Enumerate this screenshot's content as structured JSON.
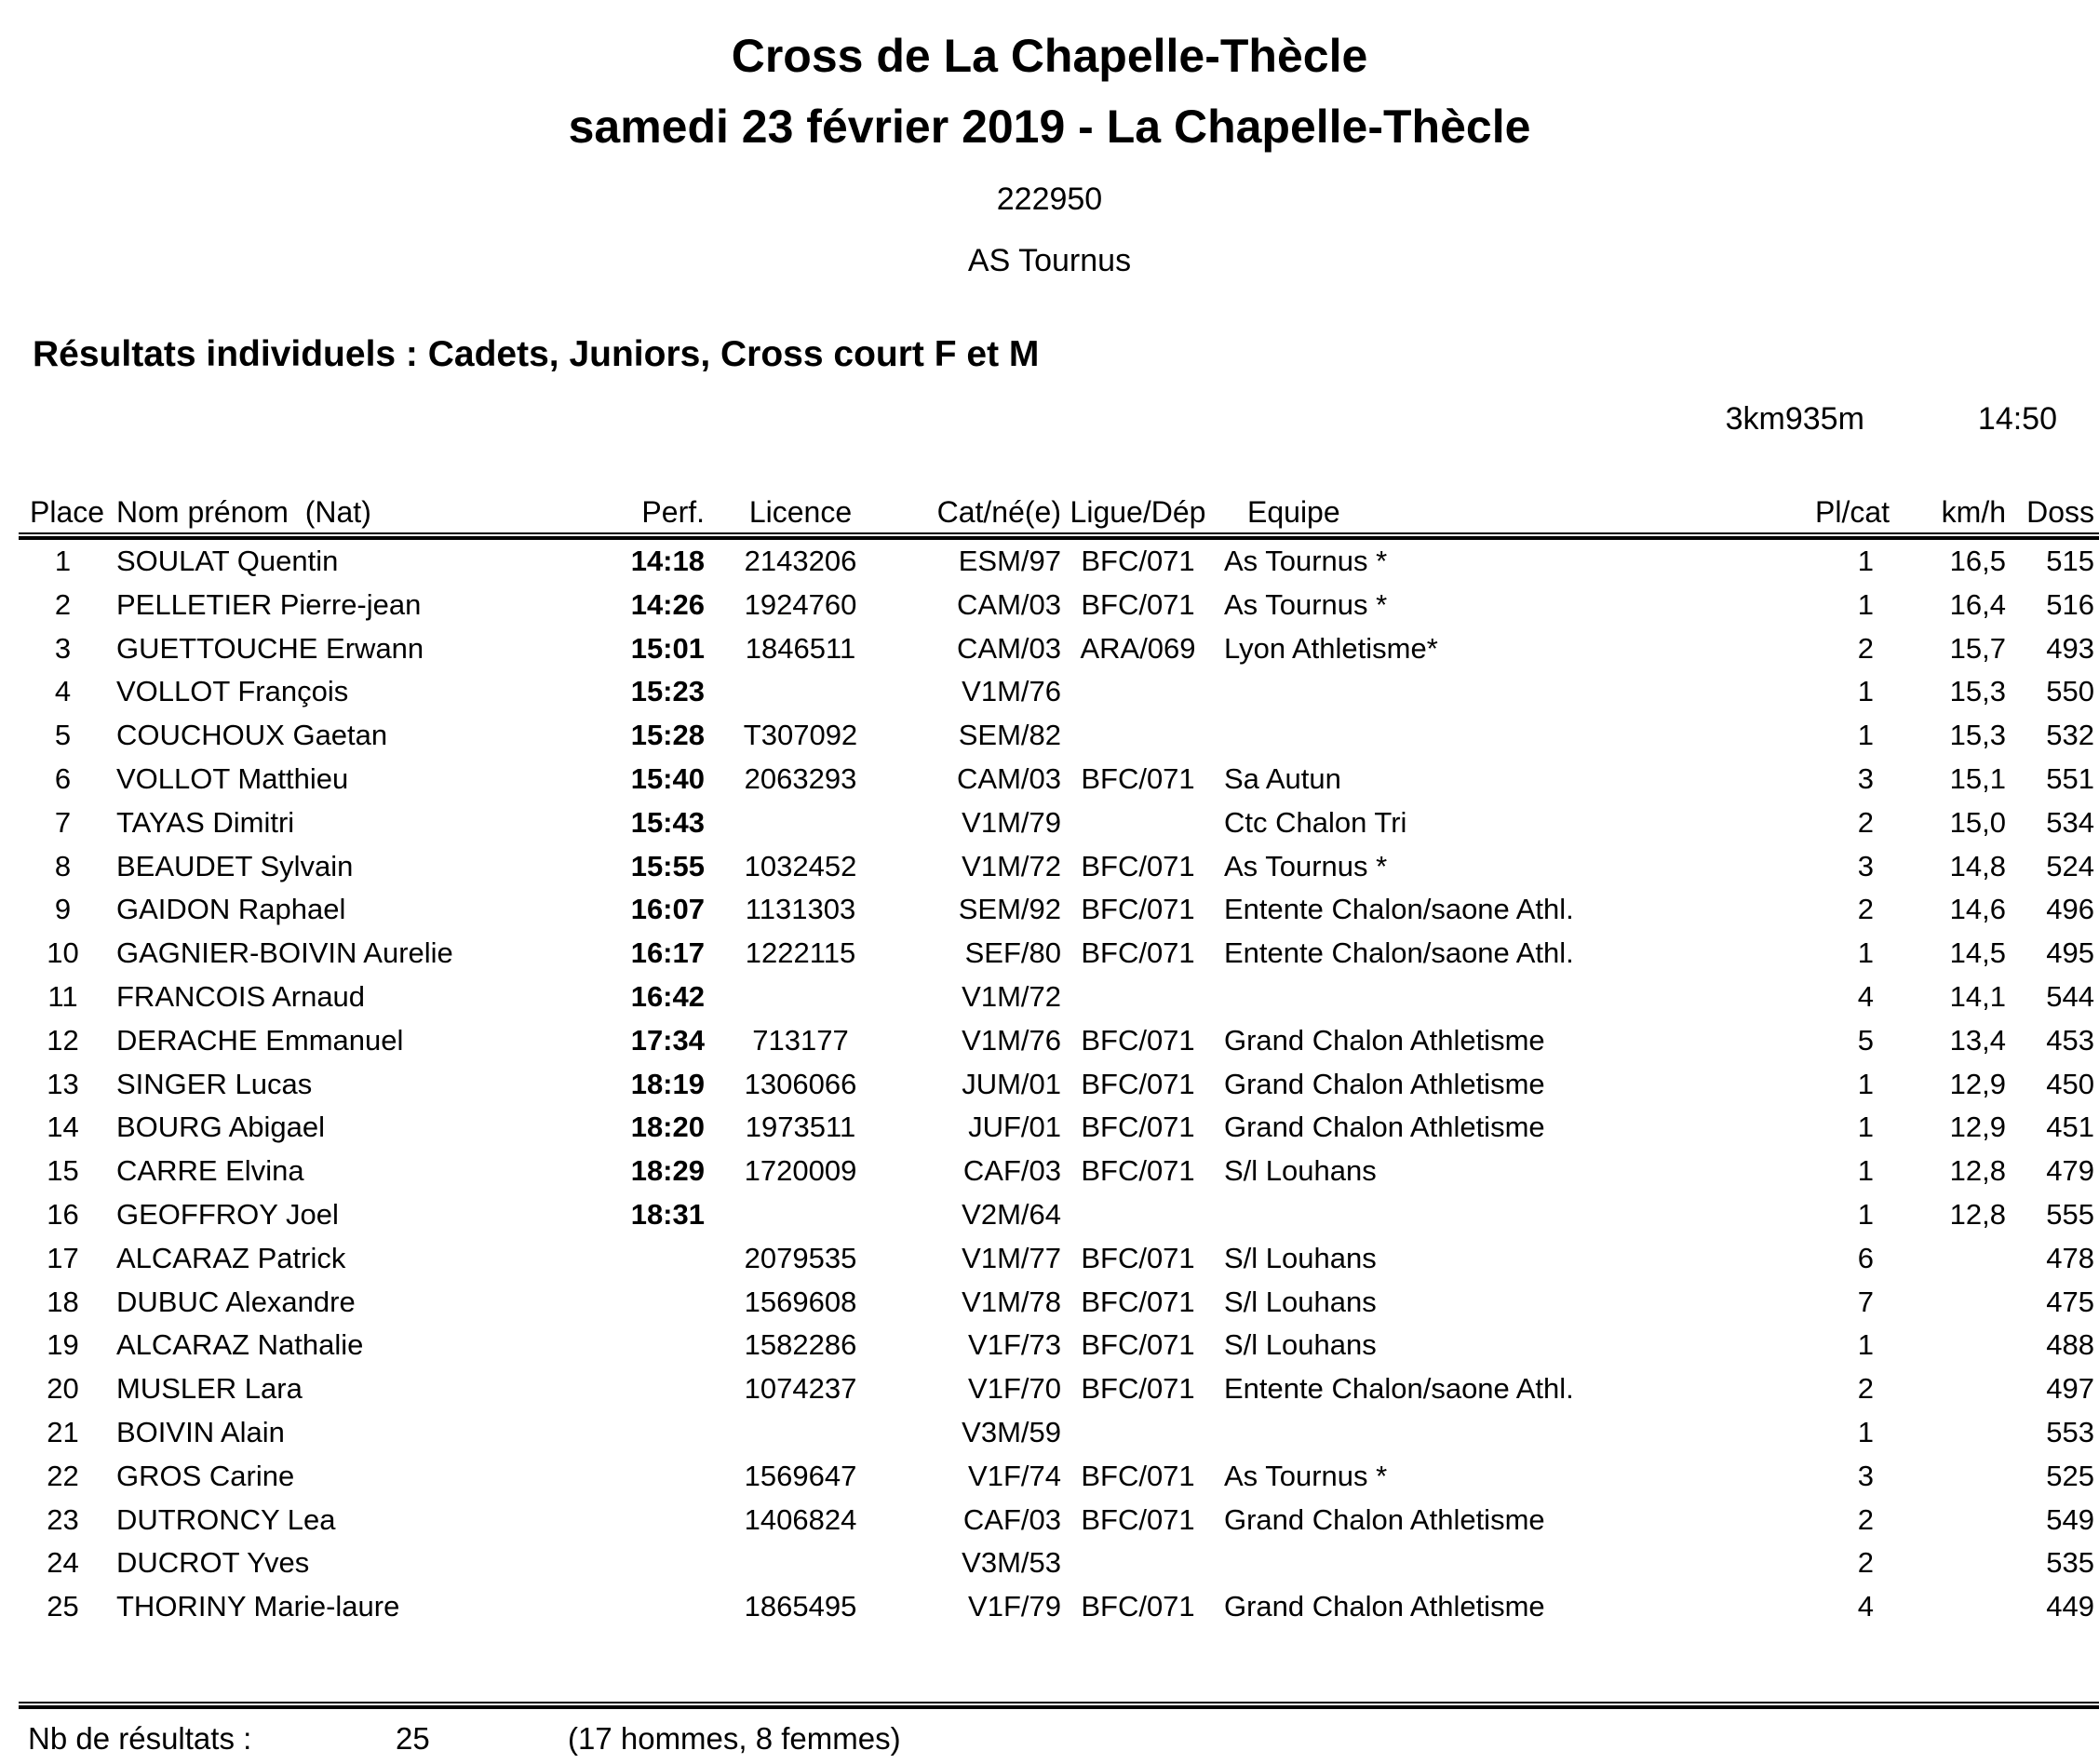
{
  "header": {
    "title": "Cross de La Chapelle-Thècle",
    "subtitle": "samedi 23 février 2019 - La Chapelle-Thècle",
    "event_code": "222950",
    "organizer": "AS Tournus"
  },
  "section": {
    "title": "Résultats individuels : Cadets, Juniors, Cross court F et M",
    "distance": "3km935m",
    "start_time": "14:50"
  },
  "table": {
    "columns": [
      "Place",
      "Nom prénom  (Nat)",
      "Perf.",
      "Licence",
      "Cat/né(e)",
      "Ligue/Dép",
      "Equipe",
      "Pl/cat",
      "km/h",
      "Doss"
    ],
    "rows": [
      {
        "place": "1",
        "name": "SOULAT Quentin",
        "perf": "14:18",
        "licence": "2143206",
        "cat": "ESM/97",
        "ligue": "BFC/071",
        "equipe": "As Tournus *",
        "plcat": "1",
        "kmh": "16,5",
        "doss": "515"
      },
      {
        "place": "2",
        "name": "PELLETIER Pierre-jean",
        "perf": "14:26",
        "licence": "1924760",
        "cat": "CAM/03",
        "ligue": "BFC/071",
        "equipe": "As Tournus *",
        "plcat": "1",
        "kmh": "16,4",
        "doss": "516"
      },
      {
        "place": "3",
        "name": "GUETTOUCHE Erwann",
        "perf": "15:01",
        "licence": "1846511",
        "cat": "CAM/03",
        "ligue": "ARA/069",
        "equipe": "Lyon Athletisme*",
        "plcat": "2",
        "kmh": "15,7",
        "doss": "493"
      },
      {
        "place": "4",
        "name": "VOLLOT François",
        "perf": "15:23",
        "licence": "",
        "cat": "V1M/76",
        "ligue": "",
        "equipe": "",
        "plcat": "1",
        "kmh": "15,3",
        "doss": "550"
      },
      {
        "place": "5",
        "name": "COUCHOUX Gaetan",
        "perf": "15:28",
        "licence": "T307092",
        "cat": "SEM/82",
        "ligue": "",
        "equipe": "",
        "plcat": "1",
        "kmh": "15,3",
        "doss": "532"
      },
      {
        "place": "6",
        "name": "VOLLOT Matthieu",
        "perf": "15:40",
        "licence": "2063293",
        "cat": "CAM/03",
        "ligue": "BFC/071",
        "equipe": "Sa Autun",
        "plcat": "3",
        "kmh": "15,1",
        "doss": "551"
      },
      {
        "place": "7",
        "name": "TAYAS Dimitri",
        "perf": "15:43",
        "licence": "",
        "cat": "V1M/79",
        "ligue": "",
        "equipe": "Ctc Chalon Tri",
        "plcat": "2",
        "kmh": "15,0",
        "doss": "534"
      },
      {
        "place": "8",
        "name": "BEAUDET Sylvain",
        "perf": "15:55",
        "licence": "1032452",
        "cat": "V1M/72",
        "ligue": "BFC/071",
        "equipe": "As Tournus *",
        "plcat": "3",
        "kmh": "14,8",
        "doss": "524"
      },
      {
        "place": "9",
        "name": "GAIDON Raphael",
        "perf": "16:07",
        "licence": "1131303",
        "cat": "SEM/92",
        "ligue": "BFC/071",
        "equipe": "Entente Chalon/saone Athl.",
        "plcat": "2",
        "kmh": "14,6",
        "doss": "496"
      },
      {
        "place": "10",
        "name": "GAGNIER-BOIVIN Aurelie",
        "perf": "16:17",
        "licence": "1222115",
        "cat": "SEF/80",
        "ligue": "BFC/071",
        "equipe": "Entente Chalon/saone Athl.",
        "plcat": "1",
        "kmh": "14,5",
        "doss": "495"
      },
      {
        "place": "11",
        "name": "FRANCOIS Arnaud",
        "perf": "16:42",
        "licence": "",
        "cat": "V1M/72",
        "ligue": "",
        "equipe": "",
        "plcat": "4",
        "kmh": "14,1",
        "doss": "544"
      },
      {
        "place": "12",
        "name": "DERACHE Emmanuel",
        "perf": "17:34",
        "licence": "713177",
        "cat": "V1M/76",
        "ligue": "BFC/071",
        "equipe": "Grand Chalon Athletisme",
        "plcat": "5",
        "kmh": "13,4",
        "doss": "453"
      },
      {
        "place": "13",
        "name": "SINGER Lucas",
        "perf": "18:19",
        "licence": "1306066",
        "cat": "JUM/01",
        "ligue": "BFC/071",
        "equipe": "Grand Chalon Athletisme",
        "plcat": "1",
        "kmh": "12,9",
        "doss": "450"
      },
      {
        "place": "14",
        "name": "BOURG Abigael",
        "perf": "18:20",
        "licence": "1973511",
        "cat": "JUF/01",
        "ligue": "BFC/071",
        "equipe": "Grand Chalon Athletisme",
        "plcat": "1",
        "kmh": "12,9",
        "doss": "451"
      },
      {
        "place": "15",
        "name": "CARRE Elvina",
        "perf": "18:29",
        "licence": "1720009",
        "cat": "CAF/03",
        "ligue": "BFC/071",
        "equipe": "S/l Louhans",
        "plcat": "1",
        "kmh": "12,8",
        "doss": "479"
      },
      {
        "place": "16",
        "name": "GEOFFROY Joel",
        "perf": "18:31",
        "licence": "",
        "cat": "V2M/64",
        "ligue": "",
        "equipe": "",
        "plcat": "1",
        "kmh": "12,8",
        "doss": "555"
      },
      {
        "place": "17",
        "name": "ALCARAZ Patrick",
        "perf": "",
        "licence": "2079535",
        "cat": "V1M/77",
        "ligue": "BFC/071",
        "equipe": "S/l Louhans",
        "plcat": "6",
        "kmh": "",
        "doss": "478"
      },
      {
        "place": "18",
        "name": "DUBUC Alexandre",
        "perf": "",
        "licence": "1569608",
        "cat": "V1M/78",
        "ligue": "BFC/071",
        "equipe": "S/l Louhans",
        "plcat": "7",
        "kmh": "",
        "doss": "475"
      },
      {
        "place": "19",
        "name": "ALCARAZ Nathalie",
        "perf": "",
        "licence": "1582286",
        "cat": "V1F/73",
        "ligue": "BFC/071",
        "equipe": "S/l Louhans",
        "plcat": "1",
        "kmh": "",
        "doss": "488"
      },
      {
        "place": "20",
        "name": "MUSLER Lara",
        "perf": "",
        "licence": "1074237",
        "cat": "V1F/70",
        "ligue": "BFC/071",
        "equipe": "Entente Chalon/saone Athl.",
        "plcat": "2",
        "kmh": "",
        "doss": "497"
      },
      {
        "place": "21",
        "name": "BOIVIN Alain",
        "perf": "",
        "licence": "",
        "cat": "V3M/59",
        "ligue": "",
        "equipe": "",
        "plcat": "1",
        "kmh": "",
        "doss": "553"
      },
      {
        "place": "22",
        "name": "GROS Carine",
        "perf": "",
        "licence": "1569647",
        "cat": "V1F/74",
        "ligue": "BFC/071",
        "equipe": "As Tournus *",
        "plcat": "3",
        "kmh": "",
        "doss": "525"
      },
      {
        "place": "23",
        "name": "DUTRONCY Lea",
        "perf": "",
        "licence": "1406824",
        "cat": "CAF/03",
        "ligue": "BFC/071",
        "equipe": "Grand Chalon Athletisme",
        "plcat": "2",
        "kmh": "",
        "doss": "549"
      },
      {
        "place": "24",
        "name": "DUCROT Yves",
        "perf": "",
        "licence": "",
        "cat": "V3M/53",
        "ligue": "",
        "equipe": "",
        "plcat": "2",
        "kmh": "",
        "doss": "535"
      },
      {
        "place": "25",
        "name": "THORINY Marie-laure",
        "perf": "",
        "licence": "1865495",
        "cat": "V1F/79",
        "ligue": "BFC/071",
        "equipe": "Grand Chalon Athletisme",
        "plcat": "4",
        "kmh": "",
        "doss": "449"
      }
    ]
  },
  "footer": {
    "label": "Nb de résultats :",
    "count": "25",
    "breakdown": "(17 hommes, 8 femmes)"
  }
}
